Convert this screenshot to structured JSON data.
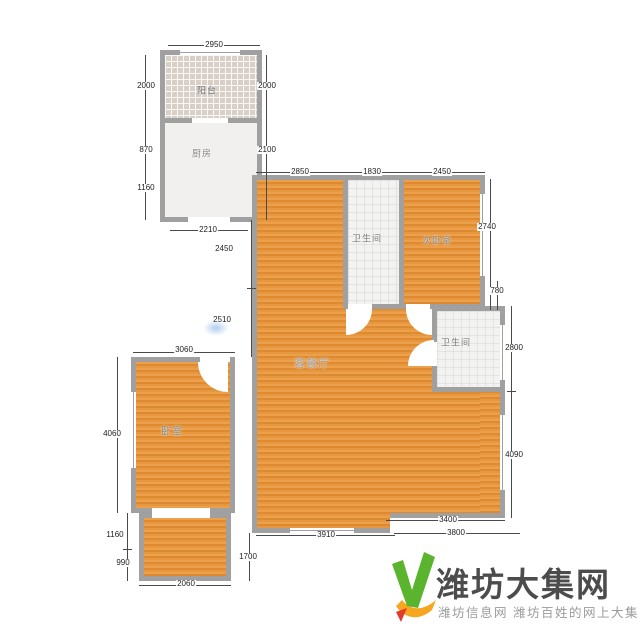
{
  "page": {
    "background": "#ffffff"
  },
  "floorplan": {
    "rooms": [
      {
        "id": "balcony",
        "label": "阳台"
      },
      {
        "id": "kitchen",
        "label": "厨房"
      },
      {
        "id": "bathroom-top",
        "label": "卫生间"
      },
      {
        "id": "bedroom-secondary",
        "label": "次卧室"
      },
      {
        "id": "bathroom-right",
        "label": "卫生间"
      },
      {
        "id": "living-dining",
        "label": "客餐厅"
      },
      {
        "id": "bedroom",
        "label": "卧室"
      }
    ],
    "dims": {
      "top_width": "2950",
      "balcony_left": "2000",
      "balcony_right": "2000",
      "kitchen_left_upper": "870",
      "kitchen_left_lower": "1160",
      "kitchen_right": "2100",
      "kitchen_bottom": "2210",
      "living_top": "2850",
      "bath_top_width": "1830",
      "bedroom2_width": "2450",
      "bedroom2_height": "2740",
      "right_gap": "780",
      "bath_right_height": "2800",
      "right_lower_height": "4090",
      "mid_left_upper": "2450",
      "mid_left_lower": "2510",
      "bedroom_width": "3060",
      "bedroom_height": "4060",
      "bottom_left_upper": "1160",
      "bottom_left_lower": "990",
      "entry_width": "2060",
      "entry_step": "1700",
      "living_bottom": "3910",
      "right_bottom_upper": "3400",
      "right_bottom_lower": "3800"
    },
    "colors": {
      "wall": "#a0a0a0",
      "floor_orange": "#e6973f"
    }
  },
  "logo": {
    "title": "潍坊大集网",
    "tagline": "潍坊信息网 潍坊百姓的网上大集",
    "colors": {
      "check_green": "#5bb42e",
      "swoosh_orange": "#f6a61f",
      "accent_red": "#e23b2e",
      "title": "#4c4c4c",
      "tagline": "#9b9b9b"
    }
  }
}
